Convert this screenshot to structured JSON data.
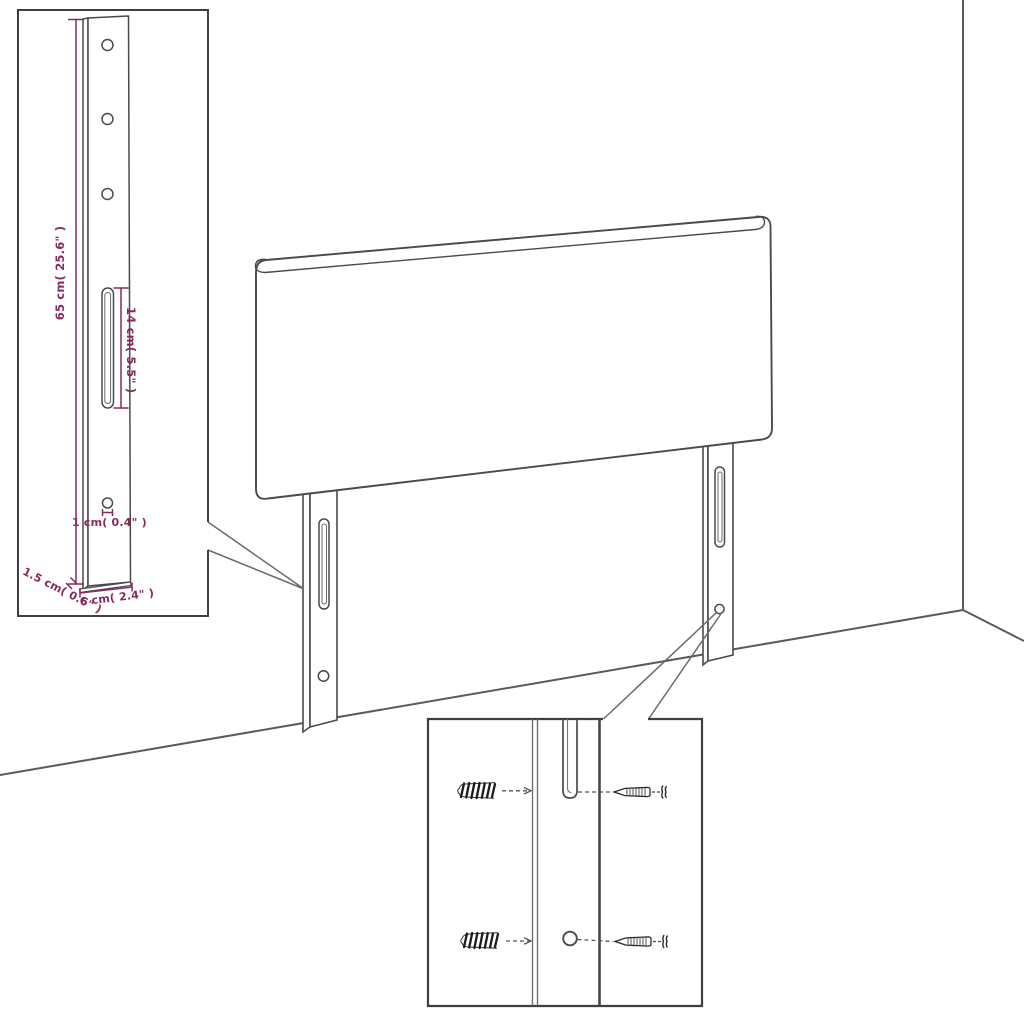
{
  "illustration": {
    "subject": "headboard with two mounting legs shown in a room corner",
    "insets": {
      "leg_detail": "enlarged mounting leg with dimensions",
      "hardware_detail": "leg slot and hole with wall plugs and screws"
    }
  },
  "inset_dimensions": {
    "height": "65 cm( 25.6\" )",
    "slot_length": "14 cm( 5.5\" )",
    "hole": "1 cm( 0.4\" )",
    "thickness": "1.5 cm( 0.6\" )",
    "width": "6 cm( 2.4\" )"
  },
  "colors": {
    "dimension_annotation": "#87295f",
    "drawing_line": "#4a4a4a",
    "box_border": "#3f3f3f",
    "background": "#ffffff"
  }
}
